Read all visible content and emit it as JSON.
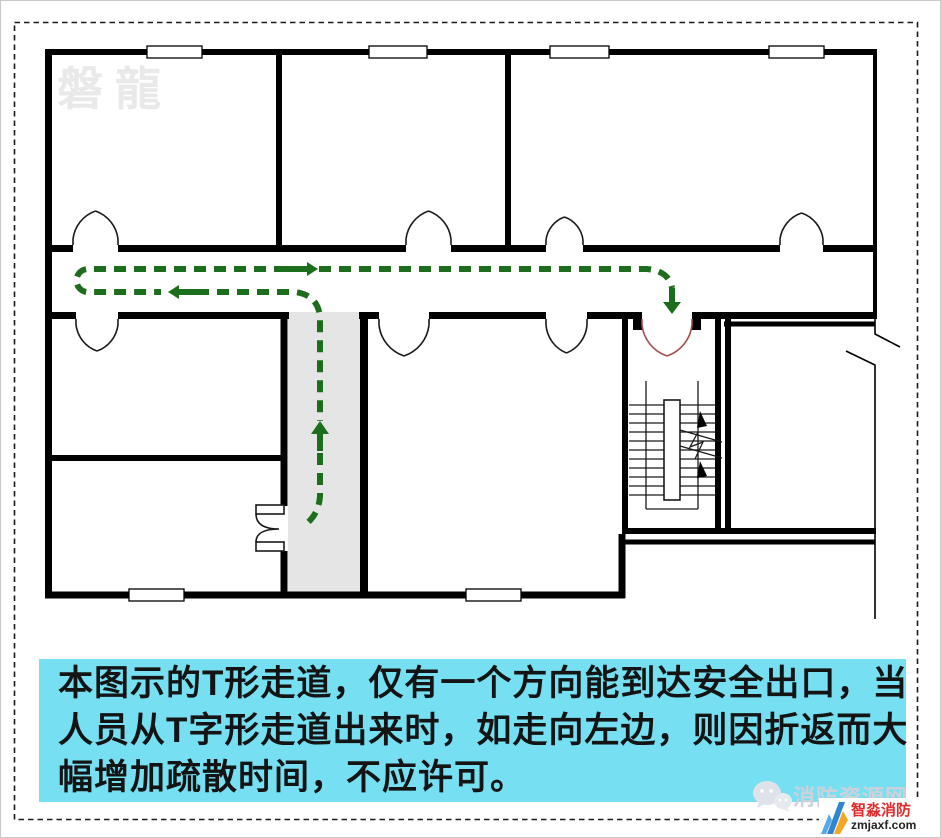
{
  "plan": {
    "watermark": "磐龍",
    "corridor_shape": "T",
    "colors": {
      "wall_black": "#000000",
      "route_green": "#1c6e1c",
      "exit_door_red": "#a34d4d",
      "corridor_gray": "#e5e5e5",
      "caption_cyan": "#76dff2"
    }
  },
  "caption": {
    "lines": [
      "本图示的T形走道，仅有一个方向能到达安全出口，当",
      "人员从T字形走道出来时，如走向左边，则因折返而大",
      "幅增加疏散时间，不应许可。"
    ]
  },
  "footer": {
    "site_name": "消防资源网",
    "chat_icon": "chat-bubbles",
    "brand_name": "智淼消防",
    "brand_url": "zmjaxf.com"
  }
}
